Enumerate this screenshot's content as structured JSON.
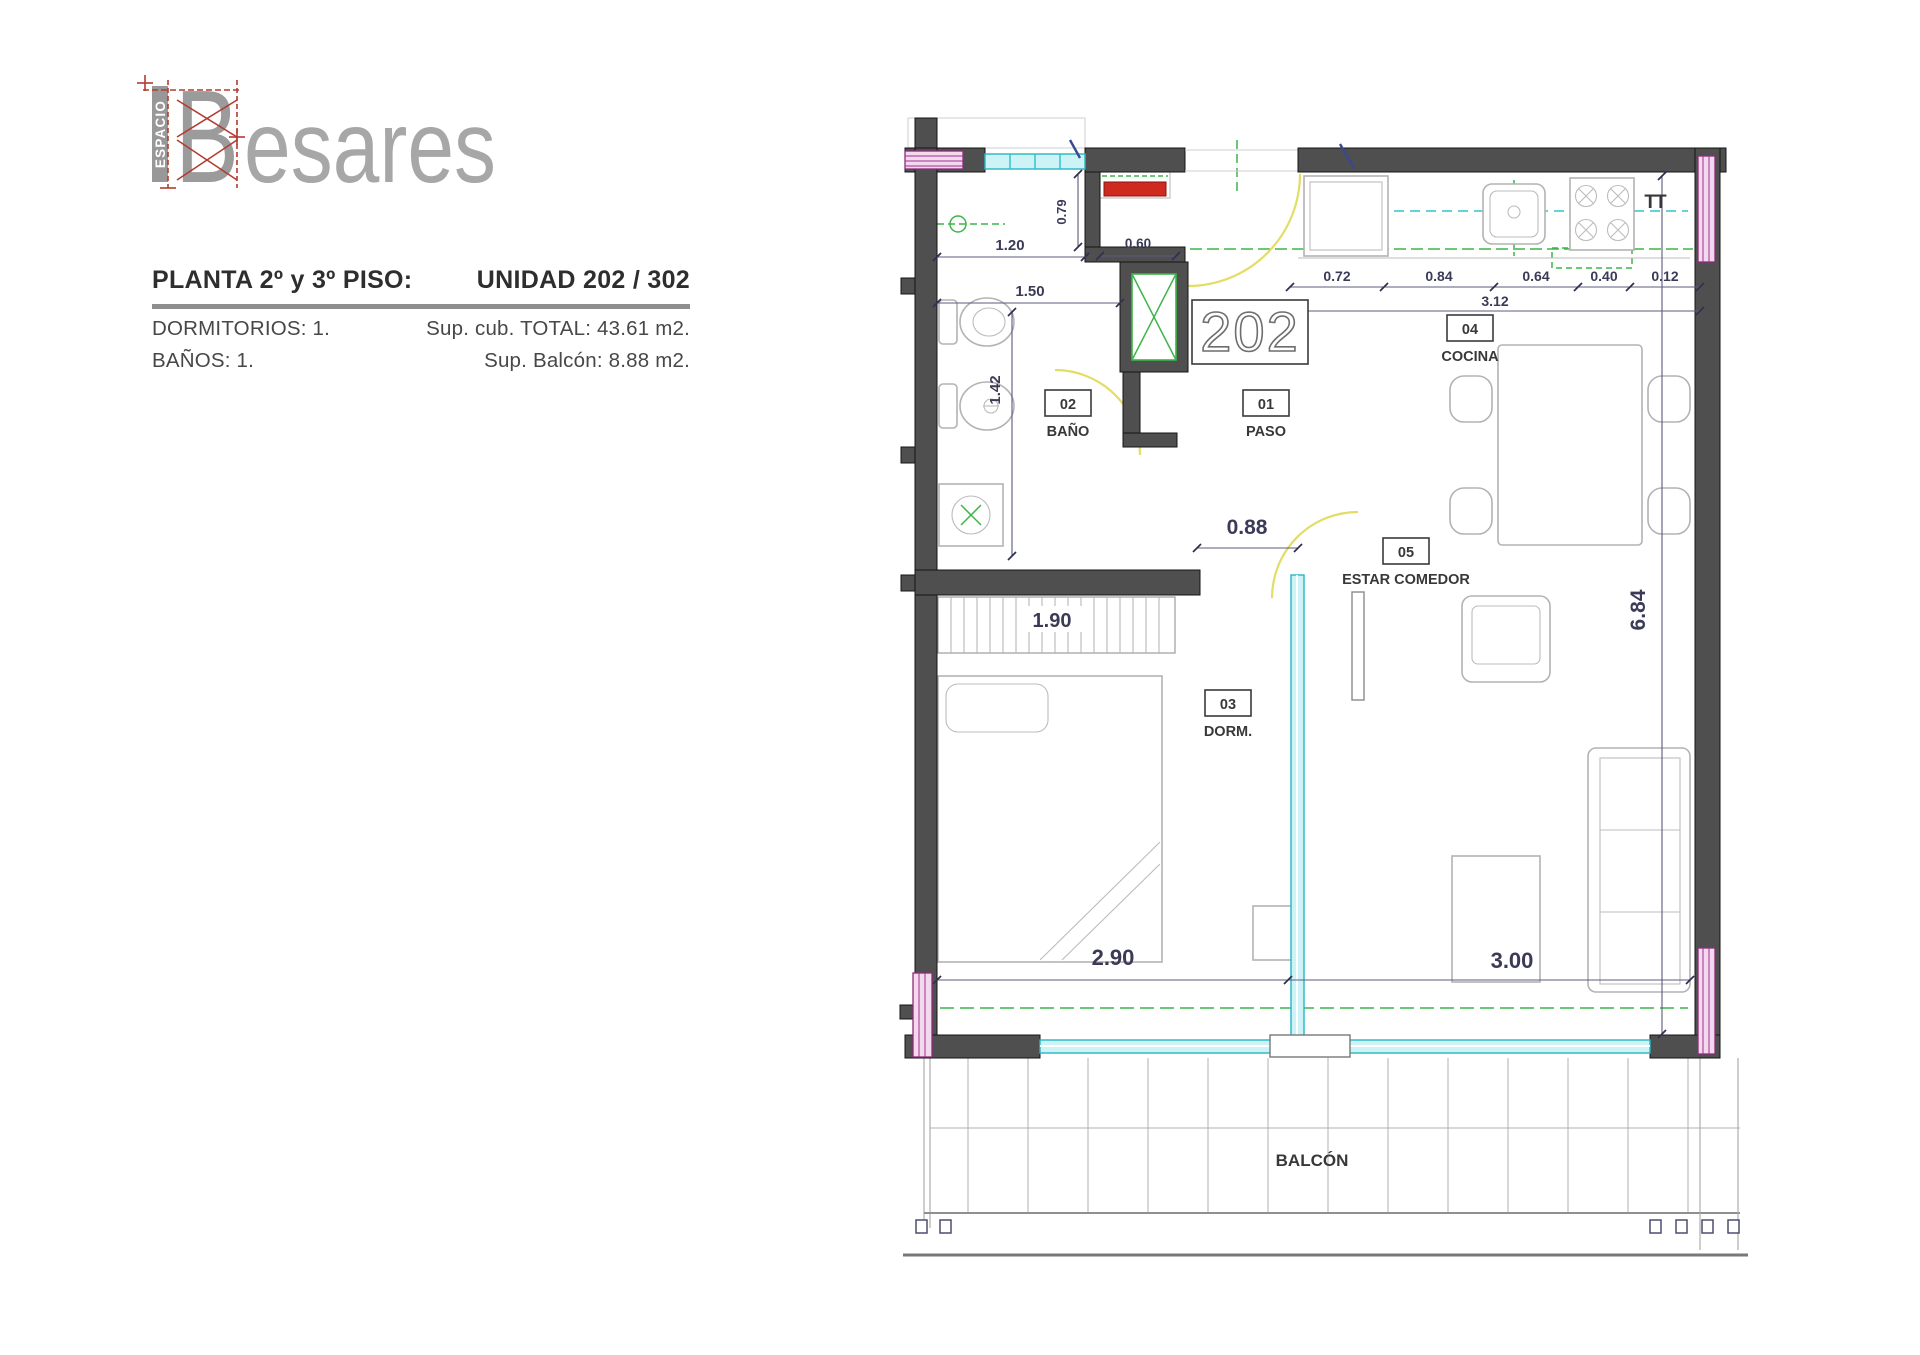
{
  "logo": {
    "vertical_text": "ESPACIO",
    "initial": "B",
    "wordmark_rest": "esares"
  },
  "header": {
    "floor_label": "PLANTA 2º y 3º PISO:",
    "unit_label": "UNIDAD 202 / 302",
    "specs": [
      {
        "left": "DORMITORIOS: 1.",
        "right": "Sup. cub. TOTAL: 43.61 m2."
      },
      {
        "left": "BAÑOS: 1.",
        "right": "Sup. Balcón: 8.88 m2."
      }
    ]
  },
  "plan": {
    "unit_number": "202",
    "tt_label": "TT",
    "balcony": "BALCÓN",
    "rooms": [
      {
        "code": "01",
        "name": "PASO"
      },
      {
        "code": "02",
        "name": "BAÑO"
      },
      {
        "code": "03",
        "name": "DORM."
      },
      {
        "code": "04",
        "name": "COCINA"
      },
      {
        "code": "05",
        "name": "ESTAR COMEDOR"
      }
    ],
    "dims": {
      "hall_width": "1.20",
      "closet_depth": "0.79",
      "paso_width": "0.60",
      "bath_width": "1.50",
      "bath_height": "1.42",
      "door_width": "0.88",
      "wardrobe_width": "1.90",
      "dorm_width": "2.90",
      "living_width": "3.00",
      "living_height": "6.84",
      "kitchen_chain": [
        "0.72",
        "0.84",
        "0.64",
        "0.40",
        "0.12"
      ],
      "kitchen_total": "3.12"
    }
  },
  "colors": {
    "wall": "#4f4f4f",
    "glass": "#28b5c4",
    "column": "#a5308f",
    "utility_green": "#3cb549",
    "door_swing": "#e3dd64",
    "appliance_red": "#cf2a1e",
    "dimension": "#3b3b57"
  }
}
